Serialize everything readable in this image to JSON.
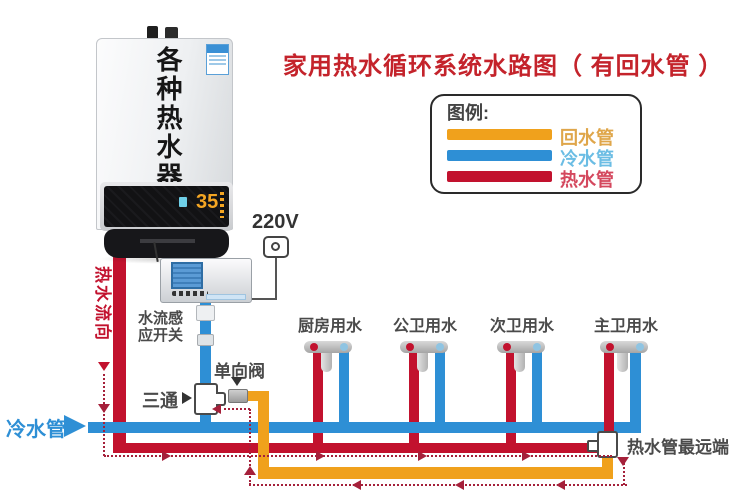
{
  "title": {
    "text": "家用热水循环系统水路图（ 有回水管 ）",
    "color": "#c4232b"
  },
  "legend": {
    "heading": "图例:",
    "items": [
      {
        "label": "回水管",
        "color": "#f0a11c"
      },
      {
        "label": "冷水管",
        "color": "#2e8fd5"
      },
      {
        "label": "热水管",
        "color": "#c2122e"
      }
    ]
  },
  "heater": {
    "name": "各种热水器",
    "display_temp": "35"
  },
  "controller": {
    "label_line1": "水流感",
    "label_line2": "应开关",
    "full_label": "水流感应开关"
  },
  "power": {
    "label": "220V"
  },
  "fittings": {
    "tee": "三通",
    "check_valve": "单向阀"
  },
  "pipes": {
    "cold_label": "冷水管",
    "hot_flow_label": "热水流向",
    "farthest_label": "热水管最远端"
  },
  "faucets": [
    {
      "label": "厨房用水"
    },
    {
      "label": "公卫用水"
    },
    {
      "label": "次卫用水"
    },
    {
      "label": "主卫用水"
    }
  ],
  "colors": {
    "hot_pipe": "#c2122e",
    "cold_pipe": "#2e8fd5",
    "return_pipe": "#f0a11c",
    "flow_arrows": "#a5203a",
    "title": "#c4232b",
    "label_text": "#4a4a4a"
  }
}
